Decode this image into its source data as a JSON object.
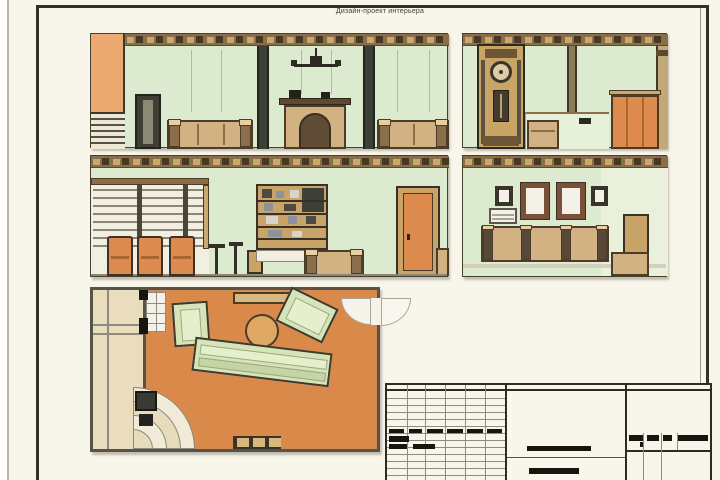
{
  "sheet": {
    "title": "Дизайн-проект интерьера"
  },
  "palette": {
    "paper": "#f8f5eb",
    "frame": "#32312a",
    "wallGreen": "#dcead0",
    "wallGreenLight": "#e9f1dc",
    "wallOrange": "#ecaa72",
    "floorOrange": "#d98a4a",
    "accentOrange": "#dd8a4e",
    "cornice": "#8a6e4a",
    "corniceDark": "#473823",
    "corniceTan": "#c9a96e",
    "tan": "#c9a469",
    "wood": "#d2b283",
    "tanDark": "#4c3c28",
    "pilaster": "#3c4036",
    "planBeige": "#e9ddbd",
    "planWall": "#55534a",
    "lineGray": "#8e8b80",
    "ink": "#16150f",
    "white": "#f4f2e8"
  },
  "views": {
    "elevation_count": 4,
    "has_floor_plan": true,
    "has_title_block": true
  }
}
